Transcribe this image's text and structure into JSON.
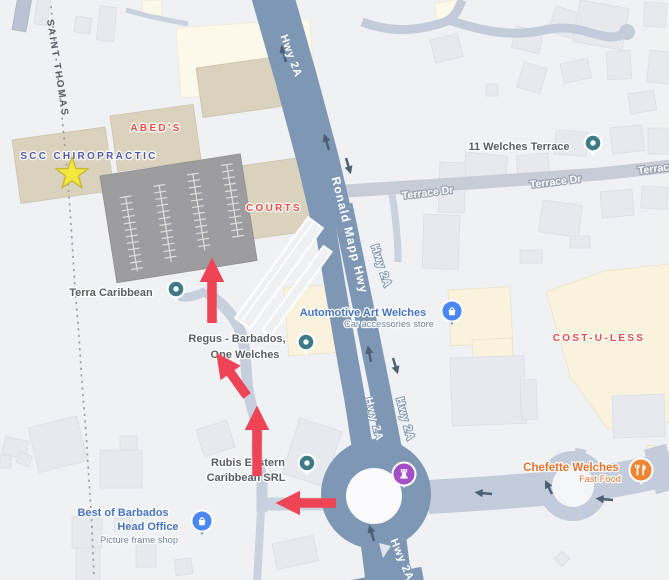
{
  "map": {
    "boundary": {
      "label": "SAINT THOMAS"
    },
    "areas": {
      "scc": "SCC CHIROPRACTIC",
      "abeds": "ABED'S",
      "courts": "COURTS",
      "costuless": "COST-U-LESS"
    },
    "roads": {
      "hwy2a": "Hwy 2A",
      "ronald_mapp": "Ronald Mapp Hwy",
      "terrace_dr": "Terrace Dr"
    },
    "pois": {
      "terra_caribbean": {
        "name": "Terra Caribbean",
        "icon": "generic-poi-pin"
      },
      "regus": {
        "line1": "Regus - Barbados,",
        "line2": "One Welches",
        "icon": "generic-poi-pin"
      },
      "automotive_art": {
        "name": "Automotive Art Welches",
        "category": "Car accessories store",
        "icon": "shopping-bag-pin"
      },
      "welches_terrace_11": {
        "name": "11 Welches Terrace",
        "icon": "generic-poi-pin"
      },
      "rubis": {
        "line1": "Rubis Eastern",
        "line2": "Caribbean SRL",
        "icon": "generic-poi-pin"
      },
      "best_of_barbados": {
        "line1": "Best of Barbados",
        "line2": "Head Office",
        "category": "Picture frame shop",
        "icon": "shopping-bag-pin"
      },
      "chefette": {
        "name": "Chefette Welches",
        "category": "Fast Food",
        "icon": "fork-knife-pin"
      },
      "roundabout_landmark": {
        "icon": "rook-landmark-pin"
      }
    },
    "route": {
      "color": "#ee4455",
      "arrow_count": 4
    },
    "marker_star": {
      "color": "#f3e93e",
      "outline": "#c9b93a",
      "location": "SCC Chiropractic"
    },
    "colors": {
      "highway": "#7e97b5",
      "minor_road": "#c6d0dd",
      "gray_road": "#c7ccd5",
      "building_beige": "#dbd2bd",
      "building_cream": "#f9f3dd",
      "parking_lot": "#9d9da0",
      "label_red": "#e94b43",
      "label_blue": "#4472c4",
      "label_scc_blue": "#4c57a8",
      "poi_gray": "#5a5d63",
      "orange": "#e8702c",
      "pin_teal": "#3f7b87",
      "pin_blue": "#4b88f5",
      "pin_orange": "#ef8533",
      "pin_purple": "#a44fc8"
    }
  }
}
